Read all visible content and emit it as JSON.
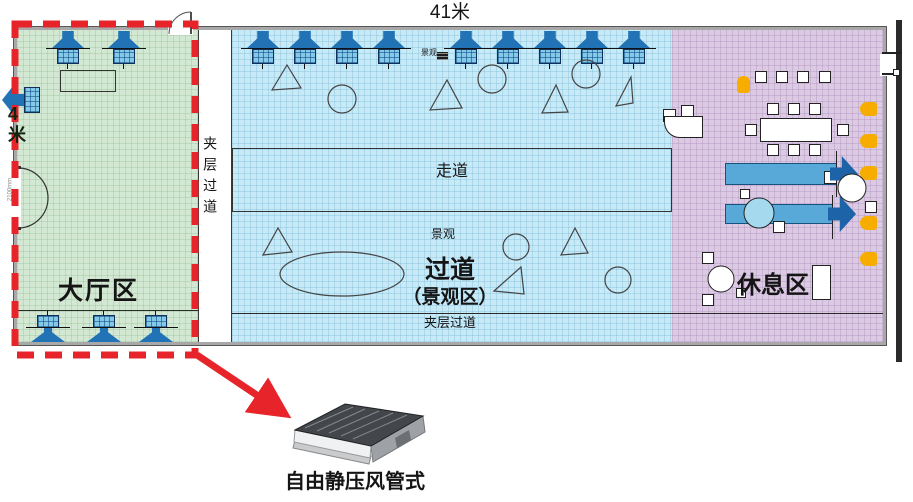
{
  "diagram": {
    "top_dimension": "41米",
    "left_dimension": "4米",
    "door_width": "2100mm"
  },
  "zones": {
    "lobby": {
      "label": "大厅区",
      "fill": "#d3e8d3"
    },
    "mezzanine_left": {
      "label": "夹层过道"
    },
    "walkway": {
      "label": "走道"
    },
    "landscape_upper": {
      "label": "景观"
    },
    "landscape_lower": {
      "label": "景观"
    },
    "corridor": {
      "label_line1": "过道",
      "label_line2": "（景观区）",
      "fill": "#c8e9f6"
    },
    "mezzanine_bottom": {
      "label": "夹层过道"
    },
    "rest": {
      "label": "休息区",
      "fill": "#dccae3"
    }
  },
  "callout": {
    "unit_label": "自由静压风管式",
    "highlight_color": "#e8242b"
  },
  "colors": {
    "vent_blue": "#2273b6",
    "furniture_orange": "#f6ad00",
    "wall_gray": "#a8a8a8"
  }
}
